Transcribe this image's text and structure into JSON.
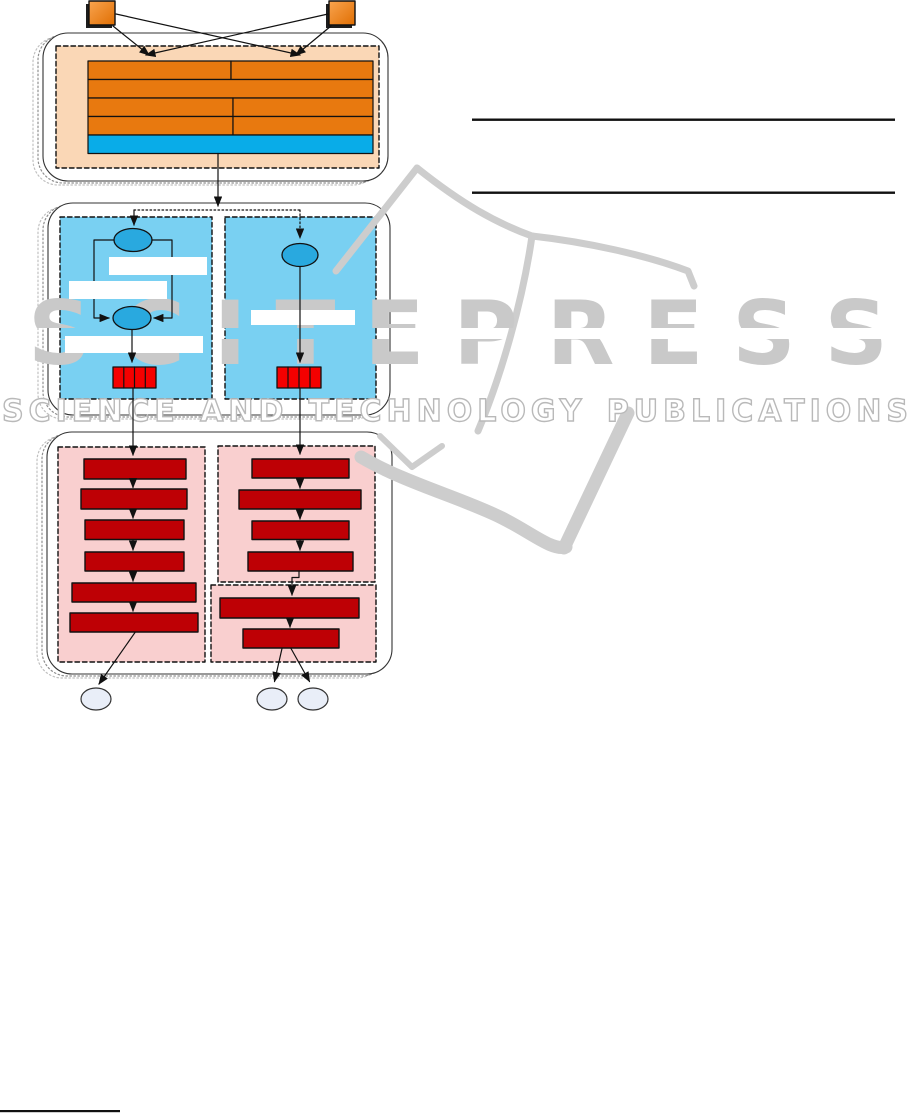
{
  "page": {
    "width": 915,
    "height": 1114,
    "background": "#ffffff"
  },
  "watermark": {
    "brand": "SCITEPRESS",
    "subtitle": "SCIENCE AND TECHNOLOGY PUBLICATIONS",
    "brand_color": "#c9c9c9",
    "outline_color": "#b9b9b9",
    "flag_color": "#cdcdcd"
  },
  "colors": {
    "orange_bar": "#E8790F",
    "orange_square_light": "#F9A44F",
    "orange_square_dark": "#E06E02",
    "peach_panel": "#FAD7B6",
    "cyan_bar": "#09ACE8",
    "blue_panel": "#79D0F2",
    "node_blue": "#29A9DF",
    "bright_red": "#F40000",
    "dark_red": "#BE0005",
    "pink_panel": "#F9CFCF",
    "pale_ellipse": "#E9EEF8",
    "ink": "#111111"
  },
  "diagram": {
    "under": [
      {
        "t": "rrect",
        "n": "stage1-ghost-outer",
        "x": 33,
        "y": 37,
        "w": 345,
        "h": 148,
        "r": 25,
        "s": "#c0c0c0",
        "dash": "1.5 2.5"
      },
      {
        "t": "rrect",
        "n": "stage1-ghost-inner",
        "x": 38,
        "y": 35,
        "w": 345,
        "h": 148,
        "r": 25,
        "s": "#8f8f8f",
        "dash": "1.5 2.5"
      },
      {
        "t": "rrect",
        "n": "stage1-container",
        "x": 43,
        "y": 33,
        "w": 345,
        "h": 148,
        "r": 25,
        "f": "#ffffff",
        "s": "#333333",
        "sw": 1.1
      },
      {
        "t": "rrect",
        "n": "stage2-ghost-outer",
        "x": 38,
        "y": 207,
        "w": 342,
        "h": 212,
        "r": 25,
        "s": "#c0c0c0",
        "dash": "1.5 2.5"
      },
      {
        "t": "rrect",
        "n": "stage2-ghost-inner",
        "x": 43,
        "y": 205,
        "w": 342,
        "h": 212,
        "r": 25,
        "s": "#8f8f8f",
        "dash": "1.5 2.5"
      },
      {
        "t": "rrect",
        "n": "stage2-container",
        "x": 48,
        "y": 203,
        "w": 342,
        "h": 212,
        "r": 25,
        "f": "#ffffff",
        "s": "#333333",
        "sw": 1.1
      },
      {
        "t": "rrect",
        "n": "stage3-ghost-outer",
        "x": 37,
        "y": 436,
        "w": 345,
        "h": 242,
        "r": 25,
        "s": "#c0c0c0",
        "dash": "1.5 2.5"
      },
      {
        "t": "rrect",
        "n": "stage3-ghost-inner",
        "x": 42,
        "y": 434,
        "w": 345,
        "h": 242,
        "r": 25,
        "s": "#8f8f8f",
        "dash": "1.5 2.5"
      },
      {
        "t": "rrect",
        "n": "stage3-container",
        "x": 47,
        "y": 432,
        "w": 345,
        "h": 242,
        "r": 25,
        "f": "#ffffff",
        "s": "#333333",
        "sw": 1.1
      },
      {
        "t": "rect",
        "n": "module-table-panel",
        "x": 56,
        "y": 46,
        "w": 323,
        "h": 122,
        "f": "#FAD7B6",
        "s": "#111111",
        "sw": 1.4,
        "dash": "4.5 3"
      },
      {
        "t": "rect",
        "n": "process-left-panel",
        "x": 60,
        "y": 217,
        "w": 152,
        "h": 182,
        "f": "#79D0F2",
        "s": "#111111",
        "sw": 1.4,
        "dash": "4.5 3"
      },
      {
        "t": "rect",
        "n": "process-right-panel",
        "x": 225,
        "y": 217,
        "w": 151,
        "h": 182,
        "f": "#79D0F2",
        "s": "#111111",
        "sw": 1.4,
        "dash": "4.5 3"
      },
      {
        "t": "rect",
        "n": "pipeline-left-panel",
        "x": 58,
        "y": 447,
        "w": 147,
        "h": 215,
        "f": "#F9CFCF",
        "s": "#111111",
        "sw": 1.4,
        "dash": "4.5 3"
      },
      {
        "t": "rect",
        "n": "pipeline-topright-panel",
        "x": 218,
        "y": 446,
        "w": 157,
        "h": 136,
        "f": "#F9CFCF",
        "s": "#111111",
        "sw": 1.4,
        "dash": "4.5 3"
      },
      {
        "t": "rect",
        "n": "pipeline-bottomright-panel",
        "x": 211,
        "y": 585,
        "w": 165,
        "h": 77,
        "f": "#F9CFCF",
        "s": "#111111",
        "sw": 1.4,
        "dash": "4.5 3"
      }
    ],
    "flag": [
      {
        "t": "path",
        "n": "wm-flag-left-edge",
        "d": "M336,271 L417,168",
        "sw": 7
      },
      {
        "t": "path",
        "n": "wm-flag-left-page-top",
        "d": "M417,168 C462,204 496,223 532,236",
        "sw": 7
      },
      {
        "t": "path",
        "n": "wm-flag-right-page-top",
        "d": "M532,236 C586,242 646,255 688,271 L694,286",
        "sw": 7
      },
      {
        "t": "path",
        "n": "wm-flag-spine",
        "d": "M532,236 C523,299 502,374 478,431",
        "sw": 7
      },
      {
        "t": "path",
        "n": "wm-flag-left-corner",
        "d": "M380,436 L412,467 L442,446",
        "sw": 6
      },
      {
        "t": "path",
        "n": "wm-flag-wave",
        "d": "M361,457 C405,483 462,498 502,518 C532,533 552,551 566,547",
        "sw": 13
      },
      {
        "t": "path",
        "n": "wm-flag-wave-rise",
        "d": "M564,548 L628,413",
        "sw": 13
      }
    ],
    "over": [
      {
        "t": "rect",
        "n": "source-left-shadow",
        "x": 86,
        "y": 4,
        "w": 26,
        "h": 24,
        "f": "#1d1d1d"
      },
      {
        "t": "rect",
        "n": "source-left-box",
        "x": 89,
        "y": 1,
        "w": 26,
        "h": 24,
        "f": "url(#gOr)",
        "s": "#111111",
        "sw": 1.4
      },
      {
        "t": "rect",
        "n": "source-right-shadow",
        "x": 326,
        "y": 4,
        "w": 26,
        "h": 24,
        "f": "#1d1d1d"
      },
      {
        "t": "rect",
        "n": "source-right-box",
        "x": 329,
        "y": 1,
        "w": 26,
        "h": 24,
        "f": "url(#gOr)",
        "s": "#111111",
        "sw": 1.4
      },
      {
        "t": "line",
        "n": "source-left-near-arrow",
        "x1": 113,
        "y1": 26,
        "x2": 149,
        "y2": 55,
        "arrow": 1
      },
      {
        "t": "line",
        "n": "source-left-cross-arrow",
        "x1": 116,
        "y1": 14,
        "x2": 300,
        "y2": 55,
        "arrow": 1
      },
      {
        "t": "line",
        "n": "source-right-near-arrow",
        "x1": 331,
        "y1": 26,
        "x2": 296,
        "y2": 55,
        "arrow": 1
      },
      {
        "t": "line",
        "n": "source-right-cross-arrow",
        "x1": 328,
        "y1": 14,
        "x2": 146,
        "y2": 55,
        "arrow": 1
      },
      {
        "t": "rect",
        "n": "table-row1-cell1",
        "x": 88,
        "y": 61,
        "w": 143,
        "h": 18.5,
        "f": "#E8790F",
        "s": "#111111",
        "sw": 1.2
      },
      {
        "t": "rect",
        "n": "table-row1-cell2",
        "x": 231,
        "y": 61,
        "w": 142,
        "h": 18.5,
        "f": "#E8790F",
        "s": "#111111",
        "sw": 1.2
      },
      {
        "t": "rect",
        "n": "table-row2-cell",
        "x": 88,
        "y": 79.5,
        "w": 285,
        "h": 18.5,
        "f": "#E8790F",
        "s": "#111111",
        "sw": 1.2
      },
      {
        "t": "rect",
        "n": "table-row3-cell1",
        "x": 88,
        "y": 98,
        "w": 145,
        "h": 18.5,
        "f": "#E8790F",
        "s": "#111111",
        "sw": 1.2
      },
      {
        "t": "rect",
        "n": "table-row3-cell2",
        "x": 233,
        "y": 98,
        "w": 140,
        "h": 18.5,
        "f": "#E8790F",
        "s": "#111111",
        "sw": 1.2
      },
      {
        "t": "rect",
        "n": "table-row4-cell1",
        "x": 88,
        "y": 116.5,
        "w": 145,
        "h": 18.5,
        "f": "#E8790F",
        "s": "#111111",
        "sw": 1.2
      },
      {
        "t": "rect",
        "n": "table-row4-cell2",
        "x": 233,
        "y": 116.5,
        "w": 140,
        "h": 18.5,
        "f": "#E8790F",
        "s": "#111111",
        "sw": 1.2
      },
      {
        "t": "rect",
        "n": "table-footer-bar",
        "x": 88,
        "y": 135,
        "w": 285,
        "h": 18.5,
        "f": "#09ACE8",
        "s": "#111111",
        "sw": 1.2
      },
      {
        "t": "line",
        "n": "stage1-to-stage2-arrow",
        "x1": 218,
        "y1": 153.5,
        "x2": 218,
        "y2": 206,
        "arrow": 1
      },
      {
        "t": "line",
        "n": "branch-horizontal-dotted",
        "x1": 134,
        "y1": 210,
        "x2": 300,
        "y2": 210,
        "dash": "1.6 2.4"
      },
      {
        "t": "line",
        "n": "branch-left-arrow",
        "x1": 134,
        "y1": 210,
        "x2": 134,
        "y2": 225,
        "arrow": 1
      },
      {
        "t": "line",
        "n": "branch-right-dotted-arrow",
        "x1": 300,
        "y1": 210,
        "x2": 300,
        "y2": 238,
        "dash": "1.6 2.4",
        "arrow": 1
      },
      {
        "t": "pline",
        "n": "loop-left-branch",
        "pts": "114,240 94,240 94,318 109,318",
        "arrow": 1
      },
      {
        "t": "pline",
        "n": "loop-right-branch",
        "pts": "152,240 172,240 172,318 154,318",
        "arrow": 1
      },
      {
        "t": "rect",
        "n": "process-left-whitebar-1",
        "x": 109,
        "y": 257,
        "w": 98,
        "h": 18,
        "f": "#ffffff"
      },
      {
        "t": "rect",
        "n": "process-left-whitebar-2",
        "x": 69,
        "y": 281,
        "w": 98,
        "h": 18,
        "f": "#ffffff"
      },
      {
        "t": "rect",
        "n": "process-left-whitebar-3",
        "x": 65,
        "y": 336,
        "w": 138,
        "h": 17,
        "f": "#ffffff"
      },
      {
        "t": "rect",
        "n": "process-right-whitebar",
        "x": 251,
        "y": 310,
        "w": 104,
        "h": 15,
        "f": "#ffffff"
      },
      {
        "t": "ellipse",
        "n": "state-node-top",
        "cx": 133,
        "cy": 240,
        "rx": 19,
        "ry": 11.5,
        "f": "#29A9DF",
        "s": "#111111",
        "sw": 1.3
      },
      {
        "t": "ellipse",
        "n": "state-node-merge",
        "cx": 132,
        "cy": 318,
        "rx": 19,
        "ry": 11.5,
        "f": "#29A9DF",
        "s": "#111111",
        "sw": 1.3
      },
      {
        "t": "ellipse",
        "n": "state-node-right",
        "cx": 300,
        "cy": 255,
        "rx": 18,
        "ry": 11.5,
        "f": "#29A9DF",
        "s": "#111111",
        "sw": 1.3
      },
      {
        "t": "line",
        "n": "merge-to-buffer-arrow",
        "x1": 132,
        "y1": 330,
        "x2": 132,
        "y2": 362,
        "arrow": 1
      },
      {
        "t": "line",
        "n": "right-node-to-buffer-arrow",
        "x1": 300,
        "y1": 267,
        "x2": 300,
        "y2": 362,
        "arrow": 1
      },
      {
        "t": "rect",
        "n": "buffer-left",
        "x": 113,
        "y": 367,
        "w": 43,
        "h": 21,
        "f": "#F40000",
        "s": "#111111",
        "sw": 1.3
      },
      {
        "t": "line",
        "n": "buffer-left-div1",
        "x1": 123.8,
        "y1": 367,
        "x2": 123.8,
        "y2": 388,
        "s2": 1
      },
      {
        "t": "line",
        "n": "buffer-left-div2",
        "x1": 134.5,
        "y1": 367,
        "x2": 134.5,
        "y2": 388,
        "s2": 1
      },
      {
        "t": "line",
        "n": "buffer-left-div3",
        "x1": 145.3,
        "y1": 367,
        "x2": 145.3,
        "y2": 388,
        "s2": 1
      },
      {
        "t": "rect",
        "n": "buffer-right",
        "x": 277,
        "y": 367,
        "w": 44,
        "h": 21,
        "f": "#F40000",
        "s": "#111111",
        "sw": 1.3
      },
      {
        "t": "line",
        "n": "buffer-right-div1",
        "x1": 288,
        "y1": 367,
        "x2": 288,
        "y2": 388,
        "s2": 1
      },
      {
        "t": "line",
        "n": "buffer-right-div2",
        "x1": 299,
        "y1": 367,
        "x2": 299,
        "y2": 388,
        "s2": 1
      },
      {
        "t": "line",
        "n": "buffer-right-div3",
        "x1": 310,
        "y1": 367,
        "x2": 310,
        "y2": 388,
        "s2": 1
      },
      {
        "t": "line",
        "n": "stage2-left-exit-arrow",
        "x1": 133,
        "y1": 388,
        "x2": 133,
        "y2": 455,
        "arrow": 1
      },
      {
        "t": "line",
        "n": "stage2-right-exit-arrow",
        "x1": 300,
        "y1": 388,
        "x2": 300,
        "y2": 454,
        "arrow": 1
      },
      {
        "t": "rect",
        "n": "step-left-1",
        "x": 84,
        "y": 459,
        "w": 102,
        "h": 20,
        "f": "#BE0005",
        "s": "#111111",
        "sw": 1.4
      },
      {
        "t": "rect",
        "n": "step-left-2",
        "x": 81,
        "y": 489,
        "w": 106,
        "h": 20,
        "f": "#BE0005",
        "s": "#111111",
        "sw": 1.4
      },
      {
        "t": "rect",
        "n": "step-left-3",
        "x": 85,
        "y": 520,
        "w": 99,
        "h": 19.5,
        "f": "#BE0005",
        "s": "#111111",
        "sw": 1.4
      },
      {
        "t": "rect",
        "n": "step-left-4",
        "x": 85,
        "y": 552,
        "w": 99,
        "h": 19,
        "f": "#BE0005",
        "s": "#111111",
        "sw": 1.4
      },
      {
        "t": "rect",
        "n": "step-left-5",
        "x": 72,
        "y": 583,
        "w": 124,
        "h": 19,
        "f": "#BE0005",
        "s": "#111111",
        "sw": 1.4
      },
      {
        "t": "rect",
        "n": "step-left-6",
        "x": 70,
        "y": 613,
        "w": 128,
        "h": 19,
        "f": "#BE0005",
        "s": "#111111",
        "sw": 1.4
      },
      {
        "t": "line",
        "n": "step-left-arrow-1",
        "x1": 133,
        "y1": 479.5,
        "x2": 133,
        "y2": 487.5,
        "arrow": 1
      },
      {
        "t": "line",
        "n": "step-left-arrow-2",
        "x1": 133,
        "y1": 509.5,
        "x2": 133,
        "y2": 518,
        "arrow": 1
      },
      {
        "t": "line",
        "n": "step-left-arrow-3",
        "x1": 133,
        "y1": 540,
        "x2": 133,
        "y2": 550,
        "arrow": 1
      },
      {
        "t": "line",
        "n": "step-left-arrow-4",
        "x1": 133,
        "y1": 571.5,
        "x2": 133,
        "y2": 581,
        "arrow": 1
      },
      {
        "t": "line",
        "n": "step-left-arrow-5",
        "x1": 133,
        "y1": 602.5,
        "x2": 133,
        "y2": 611,
        "arrow": 1
      },
      {
        "t": "rect",
        "n": "step-right-1",
        "x": 252,
        "y": 459,
        "w": 97,
        "h": 19,
        "f": "#BE0005",
        "s": "#111111",
        "sw": 1.4
      },
      {
        "t": "rect",
        "n": "step-right-2",
        "x": 239,
        "y": 490,
        "w": 122,
        "h": 19,
        "f": "#BE0005",
        "s": "#111111",
        "sw": 1.4
      },
      {
        "t": "rect",
        "n": "step-right-3",
        "x": 252,
        "y": 521,
        "w": 97,
        "h": 18.5,
        "f": "#BE0005",
        "s": "#111111",
        "sw": 1.4
      },
      {
        "t": "rect",
        "n": "step-right-4",
        "x": 248,
        "y": 552,
        "w": 105,
        "h": 19,
        "f": "#BE0005",
        "s": "#111111",
        "sw": 1.4
      },
      {
        "t": "line",
        "n": "step-right-arrow-1",
        "x1": 300,
        "y1": 478,
        "x2": 300,
        "y2": 488,
        "arrow": 1
      },
      {
        "t": "line",
        "n": "step-right-arrow-2",
        "x1": 300,
        "y1": 509.5,
        "x2": 300,
        "y2": 519,
        "arrow": 1
      },
      {
        "t": "line",
        "n": "step-right-arrow-3",
        "x1": 300,
        "y1": 540,
        "x2": 300,
        "y2": 550,
        "arrow": 1
      },
      {
        "t": "pline",
        "n": "topright-to-bottomright-connector",
        "pts": "299,571 299,577.5 292,577.5 292,595",
        "arrow": 1
      },
      {
        "t": "rect",
        "n": "step-bottom-1",
        "x": 220,
        "y": 598,
        "w": 139,
        "h": 20,
        "f": "#BE0005",
        "s": "#111111",
        "sw": 1.4
      },
      {
        "t": "rect",
        "n": "step-bottom-2",
        "x": 243,
        "y": 629,
        "w": 96,
        "h": 19,
        "f": "#BE0005",
        "s": "#111111",
        "sw": 1.4
      },
      {
        "t": "line",
        "n": "step-bottom-arrow",
        "x1": 290,
        "y1": 618.5,
        "x2": 290,
        "y2": 627,
        "arrow": 1
      },
      {
        "t": "line",
        "n": "output-left-arrow",
        "x1": 135,
        "y1": 632.5,
        "x2": 99,
        "y2": 684,
        "arrow": 1
      },
      {
        "t": "line",
        "n": "output-mid-arrow",
        "x1": 282,
        "y1": 648.5,
        "x2": 274.5,
        "y2": 681.5,
        "arrow": 1
      },
      {
        "t": "line",
        "n": "output-right-arrow",
        "x1": 291,
        "y1": 648.5,
        "x2": 309.5,
        "y2": 681.5,
        "arrow": 1
      },
      {
        "t": "ellipse",
        "n": "result-ellipse-left",
        "cx": 96,
        "cy": 699,
        "rx": 15,
        "ry": 11,
        "f": "#E9EEF8",
        "s": "#333333",
        "sw": 1.2
      },
      {
        "t": "ellipse",
        "n": "result-ellipse-mid",
        "cx": 272,
        "cy": 699,
        "rx": 15,
        "ry": 11,
        "f": "#E9EEF8",
        "s": "#333333",
        "sw": 1.2
      },
      {
        "t": "ellipse",
        "n": "result-ellipse-right",
        "cx": 313,
        "cy": 699,
        "rx": 15,
        "ry": 11,
        "f": "#E9EEF8",
        "s": "#333333",
        "sw": 1.2
      },
      {
        "t": "rect",
        "n": "column-rule-top",
        "x": 472,
        "y": 118.5,
        "w": 423,
        "h": 2.4,
        "f": "#111111"
      },
      {
        "t": "rect",
        "n": "column-rule-bottom",
        "x": 472,
        "y": 191.5,
        "w": 423,
        "h": 2.4,
        "f": "#111111"
      },
      {
        "t": "rect",
        "n": "footnote-rule",
        "x": 0,
        "y": 1110,
        "w": 120,
        "h": 2.2,
        "f": "#111111"
      }
    ]
  }
}
